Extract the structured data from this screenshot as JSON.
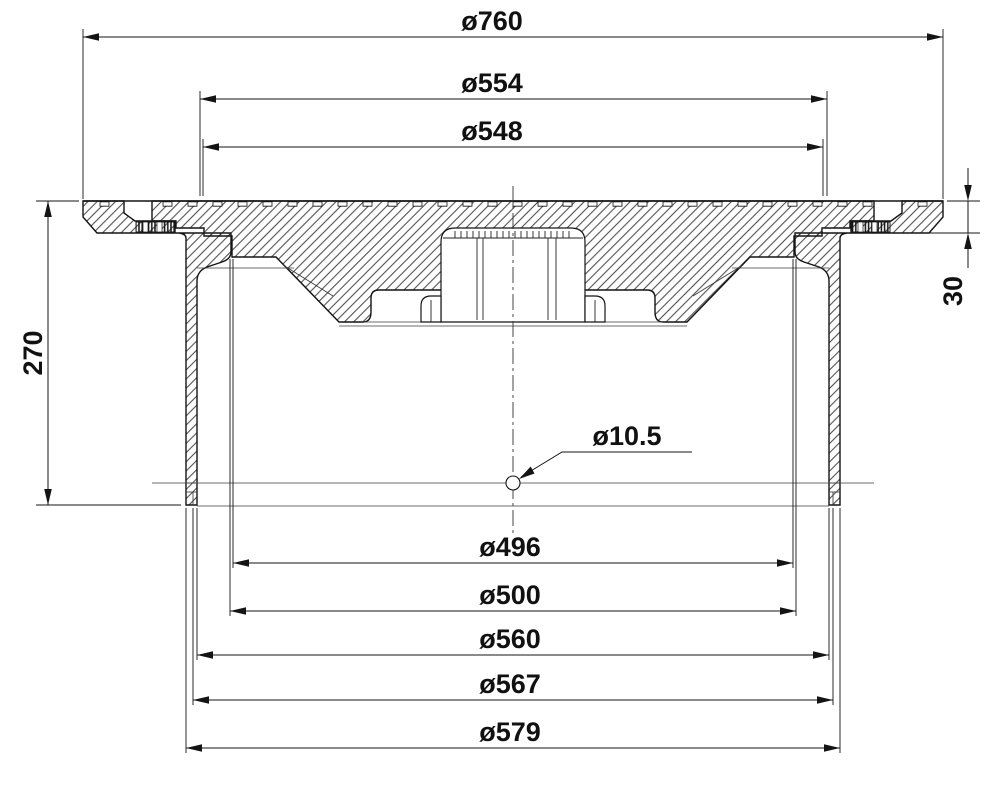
{
  "drawing": {
    "kind": "section-view",
    "subject": "circular-cover-and-frame-cross-section",
    "colors": {
      "background": "#ffffff",
      "line": "#141414"
    },
    "dims": {
      "top": [
        {
          "label": "ø760",
          "value": 760,
          "type": "diameter"
        },
        {
          "label": "ø554",
          "value": 554,
          "type": "diameter"
        },
        {
          "label": "ø548",
          "value": 548,
          "type": "diameter"
        }
      ],
      "bottom": [
        {
          "label": "ø496",
          "value": 496,
          "type": "diameter"
        },
        {
          "label": "ø500",
          "value": 500,
          "type": "diameter"
        },
        {
          "label": "ø560",
          "value": 560,
          "type": "diameter"
        },
        {
          "label": "ø567",
          "value": 567,
          "type": "diameter"
        },
        {
          "label": "ø579",
          "value": 579,
          "type": "diameter"
        }
      ],
      "left": {
        "label": "270",
        "value": 270,
        "type": "height"
      },
      "right": {
        "label": "30",
        "value": 30,
        "type": "height"
      },
      "hole": {
        "label": "ø10.5",
        "value": 10.5,
        "type": "diameter"
      }
    }
  }
}
